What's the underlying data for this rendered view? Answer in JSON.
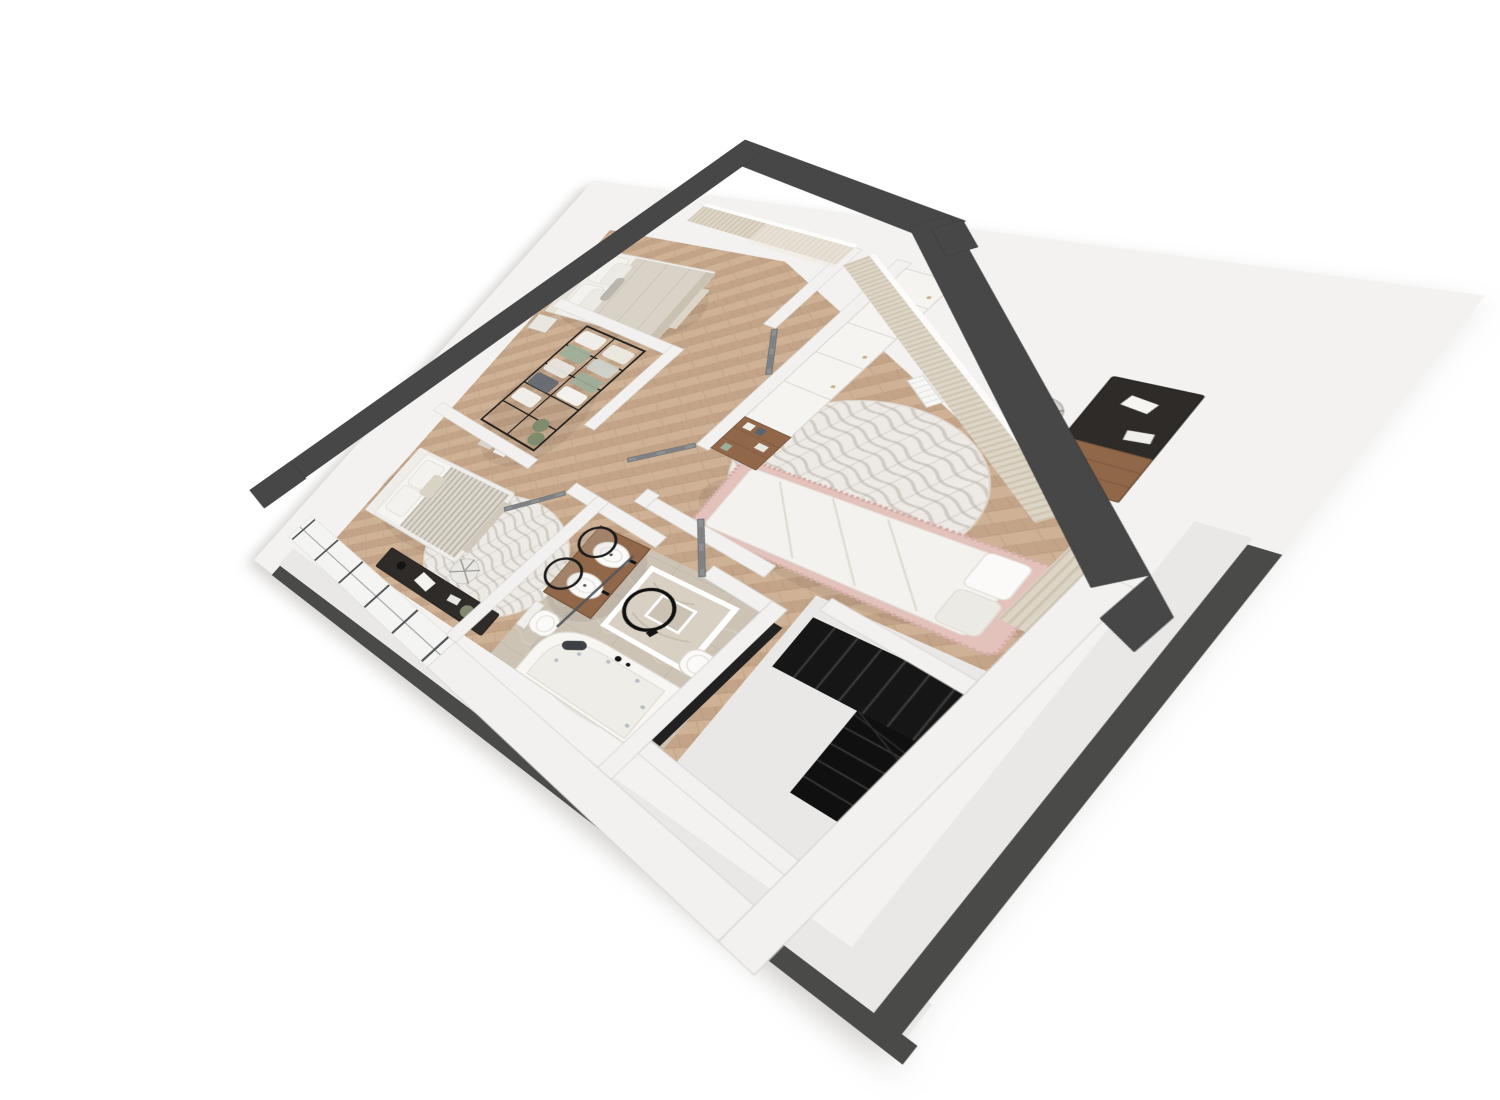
{
  "meta": {
    "title": "3D isometric floor plan render - upper storey",
    "view": "axonometric top-down 3d render",
    "background": "#ffffff"
  },
  "palette": {
    "wallDark": "#474747",
    "wallDarker": "#3a3a3a",
    "wallInt": "#f2f1ef",
    "wallEdge": "#d4d2cf",
    "slab": "#e9e8e6",
    "slabDark": "#4a4a49",
    "backdrop": "#f3f2f0",
    "woodA": "#c3a488",
    "woodB": "#cfb295",
    "woodLine": "#a78a6e",
    "tile": "#ccc3b5",
    "tileLine": "#bdb4a6",
    "tileVein": "#d8d0c3",
    "rugBase": "#edeae5",
    "rugStreak": "#b4aba1",
    "white": "#f4f2ee",
    "cream": "#d9d2c6",
    "creamDark": "#c7bfb1",
    "stripe": "#b5aea3",
    "pink": "#e4c2bc",
    "pinkDark": "#d4aea7",
    "doorGray": "#8e9193",
    "doorDark": "#6e7173",
    "black": "#1b1b1b",
    "deskDark": "#2e2b28",
    "woodFurn": "#916749",
    "woodFurnDark": "#7c583c",
    "chair": "#d6d4d0",
    "chairEdge": "#b9b6b1",
    "curtain": "#ddd5c6",
    "curtainStripe": "#cec4b2",
    "glassFrame": "#55585a",
    "stairBlack": "#161616",
    "stairLine": "#3a3a3a",
    "plant": "#7e8b6d",
    "sage": "#9fae9b",
    "navy": "#5a6470"
  },
  "rooms": [
    {
      "id": "master-bedroom",
      "name": "Master bedroom",
      "floor": "herringbone wood",
      "furniture": [
        "double bed with beige blanket",
        "two nightstands",
        "floor-to-ceiling curtains"
      ]
    },
    {
      "id": "walk-in-closet",
      "name": "Walk-in closet",
      "floor": "herringbone wood",
      "furniture": [
        "black metal open clothes rack with hanging garments",
        "plant",
        "storage boxes"
      ]
    },
    {
      "id": "left-bedroom",
      "name": "Second bedroom",
      "floor": "herringbone wood",
      "furniture": [
        "white bed with striped blanket",
        "round marble-pattern rug",
        "dark desk",
        "white office chair",
        "glazed partition wall"
      ]
    },
    {
      "id": "kids-bedroom",
      "name": "Kids bedroom",
      "floor": "herringbone wood",
      "furniture": [
        "white wardrobe with open shelving",
        "dark desk with wooden drawers",
        "grey office chair",
        "round marble-pattern rug",
        "pink ruffled bed with white duvet",
        "curtains"
      ]
    },
    {
      "id": "bathroom",
      "name": "Bathroom",
      "floor": "beige stone tile",
      "furniture": [
        "wooden double-sink vanity",
        "two round black-frame mirrors",
        "marble washstand with round mirror",
        "two wall-hung toilets",
        "corner jacuzzi tub",
        "glass shower screen"
      ]
    },
    {
      "id": "hallway",
      "name": "Hallway",
      "floor": "herringbone wood",
      "furniture": [
        "four grey panelled doors"
      ]
    },
    {
      "id": "stairwell",
      "name": "Stairwell",
      "floor": "screed",
      "furniture": [
        "black winder staircase"
      ]
    }
  ]
}
